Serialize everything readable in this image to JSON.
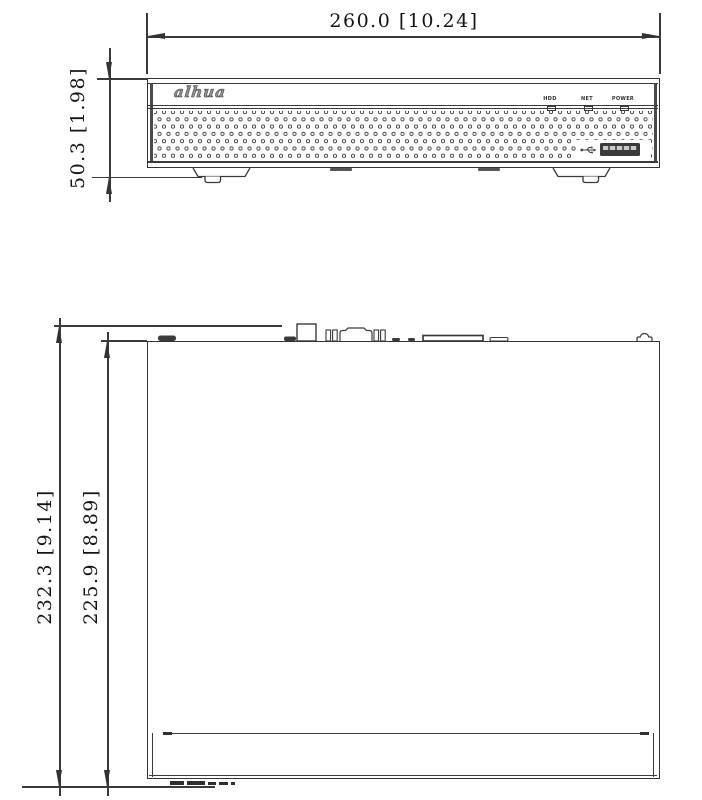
{
  "drawing": {
    "title": "device-dimension-drawing",
    "front_view": {
      "width_dim": "260.0 [10.24]",
      "height_dim": "50.3 [1.98]",
      "logo": "alhua",
      "leds": [
        {
          "label": "HDD"
        },
        {
          "label": "NET"
        },
        {
          "label": "POWER"
        }
      ]
    },
    "top_view": {
      "outer_height_dim": "232.3 [9.14]",
      "inner_height_dim": "225.9 [8.89]"
    },
    "colors": {
      "line": "#3a3a3a",
      "text": "#141414",
      "background": "#ffffff"
    }
  }
}
